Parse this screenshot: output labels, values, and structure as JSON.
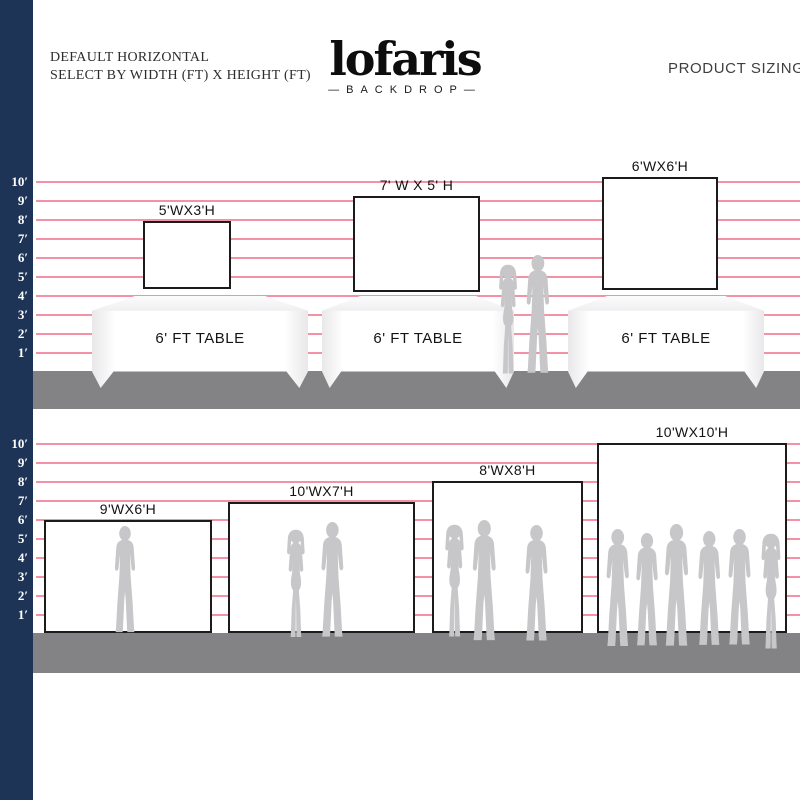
{
  "header": {
    "title_line1": "DEFAULT HORIZONTAL",
    "title_line2": "SELECT BY WIDTH (FT) X HEIGHT (FT)",
    "product_sizing": "PRODUCT SIZING"
  },
  "logo": {
    "wordmark": "lofaris",
    "subtitle": "—BACKDROP—"
  },
  "scale": {
    "unit": "ft",
    "labels": [
      "10′",
      "9′",
      "8′",
      "7′",
      "6′",
      "5′",
      "4′",
      "3′",
      "2′",
      "1′"
    ]
  },
  "top_section": {
    "backdrops": [
      {
        "label": "5'WX3'H"
      },
      {
        "label": "7' W X 5' H"
      },
      {
        "label": "6'WX6'H"
      }
    ],
    "table_label": "6' FT TABLE"
  },
  "bottom_section": {
    "backdrops": [
      {
        "label": "9'WX6'H"
      },
      {
        "label": "10'WX7'H"
      },
      {
        "label": "8'WX8'H"
      },
      {
        "label": "10'WX10'H"
      }
    ]
  },
  "colors": {
    "navy": "#1e3456",
    "pink_line": "#f192a5",
    "floor": "#838385",
    "silhouette": "#c7c7c9"
  }
}
